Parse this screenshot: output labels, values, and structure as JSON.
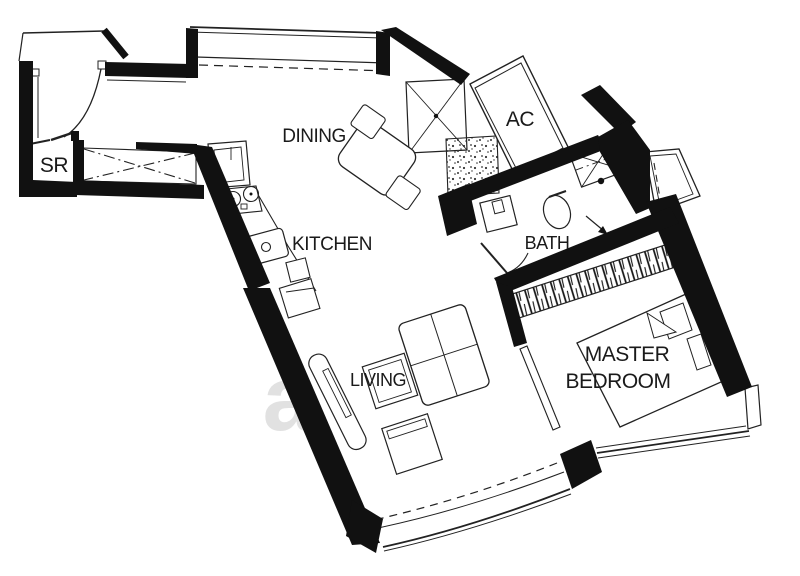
{
  "rooms": {
    "sr": "SR",
    "dining": "DINING",
    "ac": "AC",
    "kitchen": "KITCHEN",
    "bath": "BATH",
    "living": "LIVING",
    "master_bedroom": [
      "MASTER",
      "BEDROOM"
    ]
  },
  "watermark": {
    "letter": "a"
  },
  "colors": {
    "wall": "#111111",
    "line": "#222222",
    "background": "#ffffff",
    "watermark": "#cacaca"
  }
}
